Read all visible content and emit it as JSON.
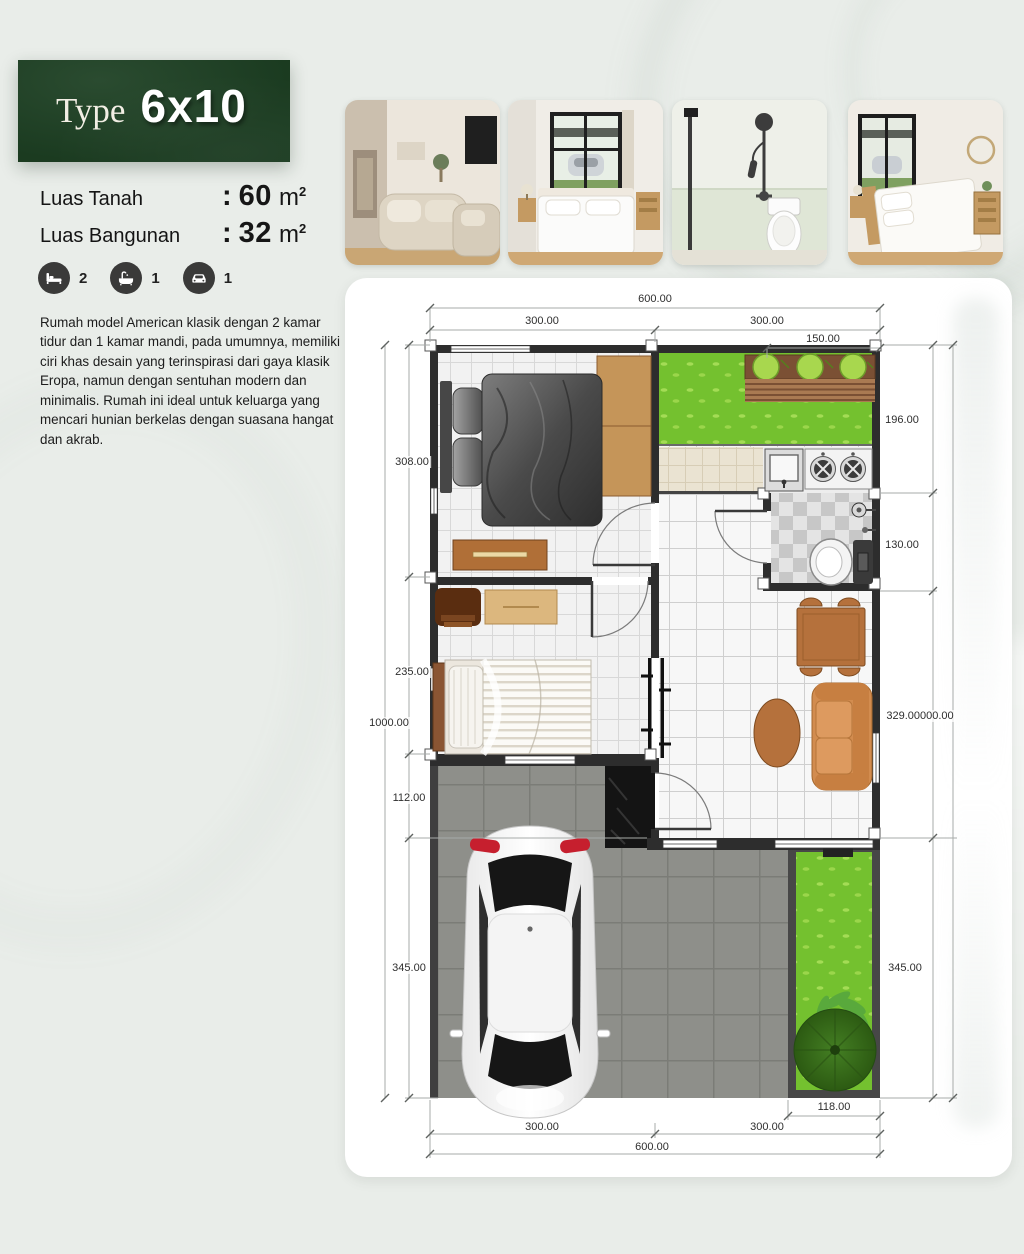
{
  "header": {
    "type_label": "Type",
    "type_value": "6x10",
    "panel_color": "#1d4023"
  },
  "specs": {
    "land": {
      "label": "Luas Tanah",
      "colon": ":",
      "value": "60",
      "unit": "m",
      "sup": "2"
    },
    "building": {
      "label": "Luas Bangunan",
      "colon": ":",
      "value": "32",
      "unit": "m",
      "sup": "2"
    }
  },
  "amenities": {
    "bedrooms": {
      "icon": "bed-icon",
      "count": "2"
    },
    "bathrooms": {
      "icon": "bathtub-icon",
      "count": "1"
    },
    "carports": {
      "icon": "car-icon",
      "count": "1"
    }
  },
  "description": "Rumah model American klasik dengan 2 kamar tidur dan 1 kamar mandi, pada umumnya, memiliki ciri khas desain yang terinspirasi dari gaya klasik Eropa, namun dengan sentuhan modern dan minimalis. Rumah ini ideal untuk keluarga yang mencari hunian berkelas dengan suasana hangat dan akrab.",
  "gallery": {
    "photo_names": [
      "living-room",
      "bedroom-with-window",
      "bathroom-shower-toilet",
      "bedroom-second"
    ]
  },
  "floorplan": {
    "dims": {
      "top_total": "600.00",
      "top_left": "300.00",
      "top_right": "300.00",
      "top_sub": "150.00",
      "left_seg1": "308.00",
      "left_seg2": "235.00",
      "left_seg3": "112.00",
      "left_seg4": "345.00",
      "left_total": "1000.00",
      "right_seg1": "196.00",
      "right_seg2": "130.00",
      "right_seg3": "329.00000.00",
      "right_seg4": "345.00",
      "bottom_sub": "118.00",
      "bottom_left": "300.00",
      "bottom_right": "300.00",
      "bottom_total": "600.00"
    }
  },
  "colors": {
    "brand_green": "#1d4023",
    "grass": "#74c12f",
    "icon_circle": "#3a3a39"
  }
}
